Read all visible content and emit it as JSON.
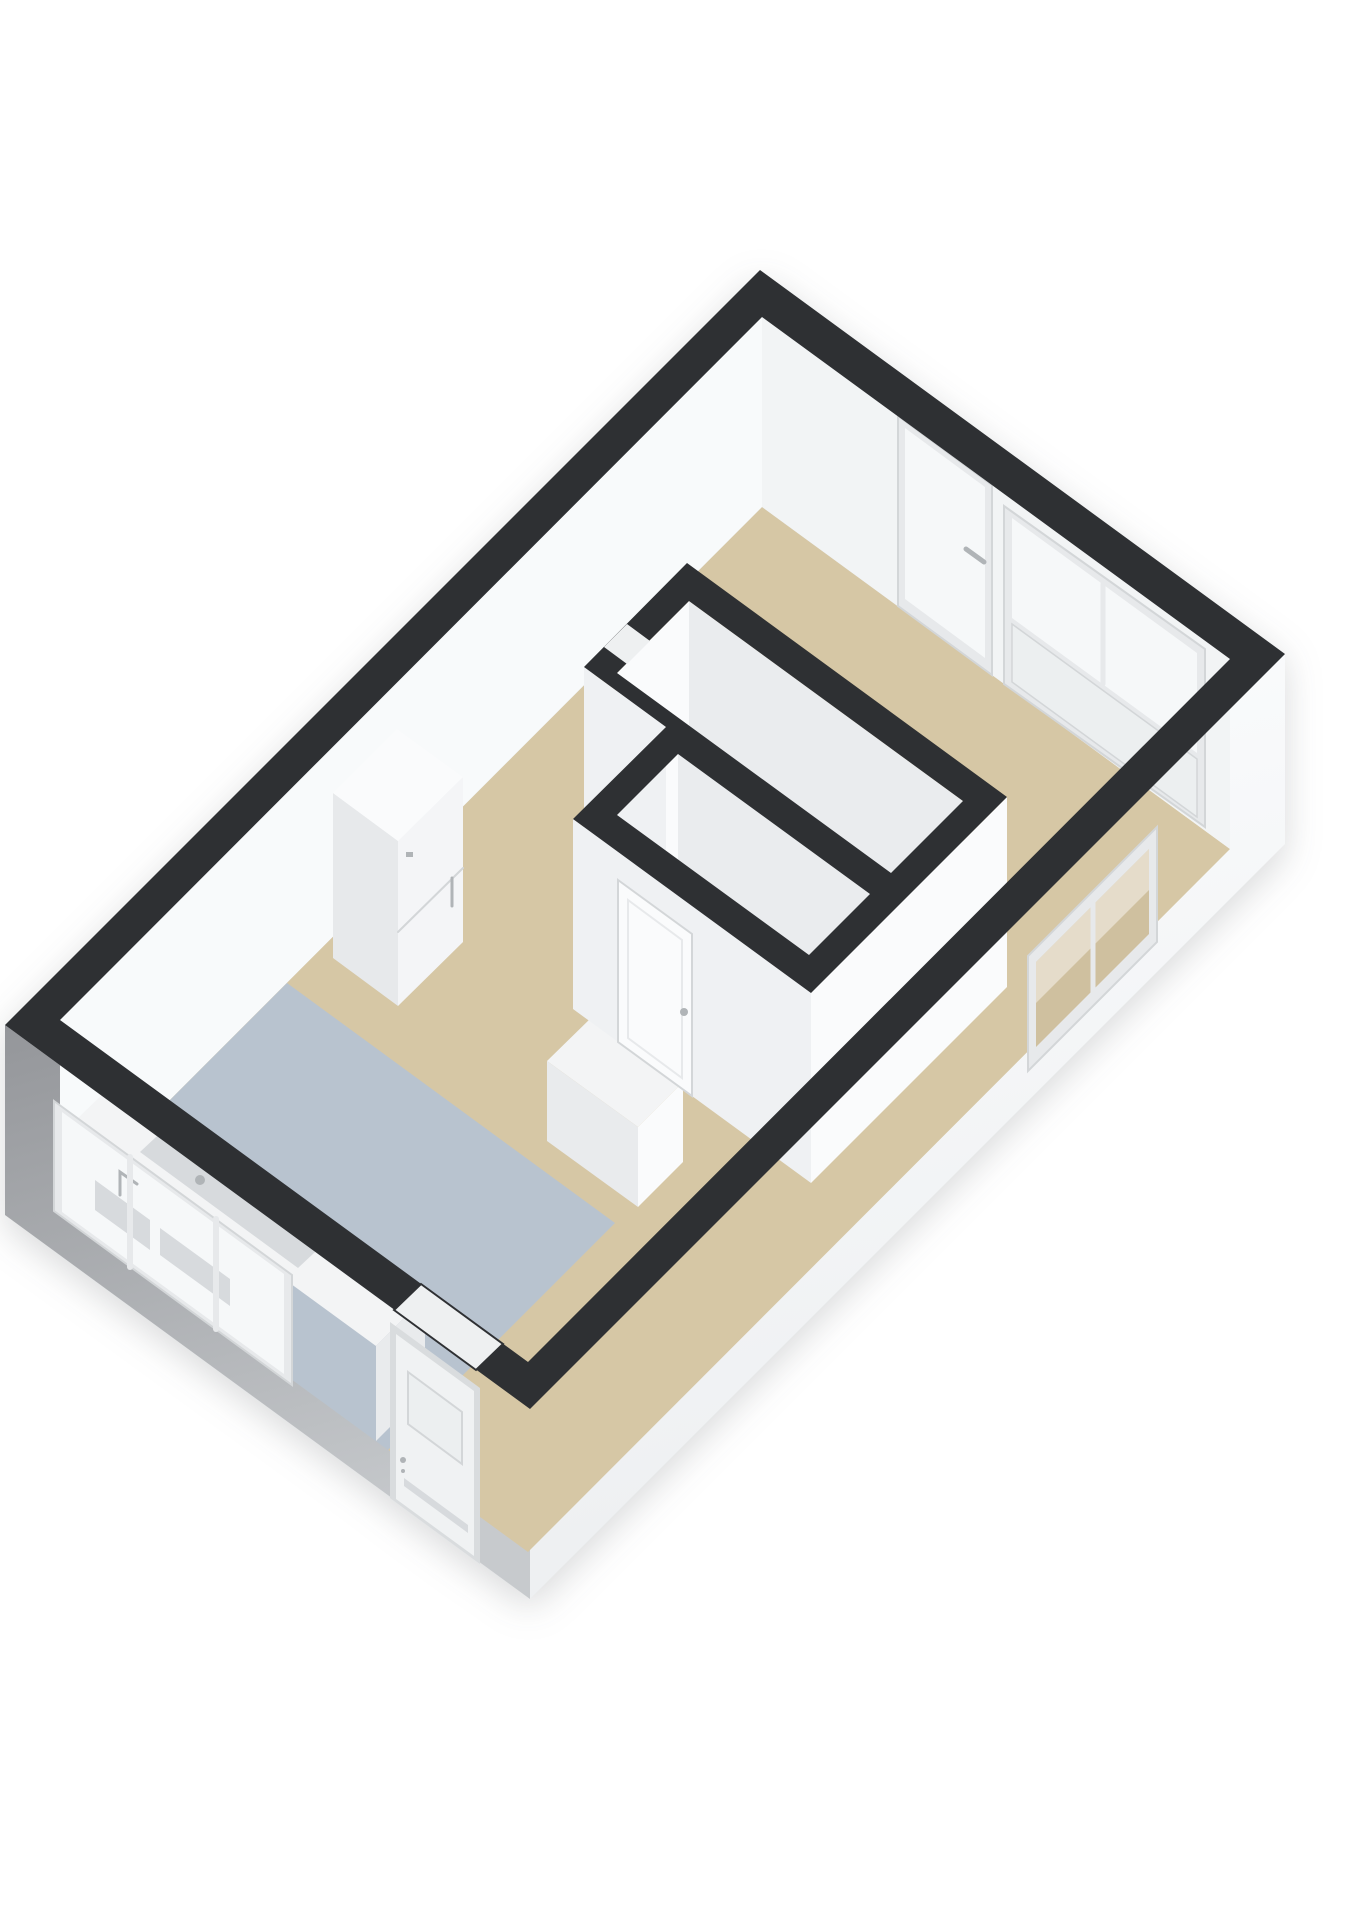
{
  "scene": {
    "type": "3d-floorplan-axonometric-view",
    "background": "#ffffff",
    "rooms": [
      {
        "id": "living-room",
        "floor_style": "beige",
        "floor_color_ref": "floor-beige"
      },
      {
        "id": "hallway",
        "floor_style": "beige",
        "floor_color_ref": "floor-beige"
      },
      {
        "id": "kitchen",
        "floor_style": "blue-gray",
        "floor_color_ref": "floor-kitchen"
      },
      {
        "id": "bathroom",
        "floor_style": "gray",
        "floor_color_ref": "floor-bathroom"
      },
      {
        "id": "toilet",
        "floor_style": "gray",
        "floor_color_ref": "floor-toilet"
      }
    ],
    "fixtures": [
      {
        "id": "tall-cabinet",
        "desc": "tall white boiler/cabinet unit against north-west wall"
      },
      {
        "id": "kitchen-counter",
        "desc": "white counter with sink along south-west wall"
      },
      {
        "id": "low-cabinet",
        "desc": "low white cabinet beside toilet block"
      }
    ],
    "openings": [
      {
        "id": "balcony-door",
        "wall": "north-east",
        "kind": "glazed door with handle"
      },
      {
        "id": "balcony-window",
        "wall": "north-east",
        "kind": "wide window with sill panel"
      },
      {
        "id": "side-window",
        "wall": "south-east",
        "kind": "window cut into outer wall"
      },
      {
        "id": "kitchen-window",
        "wall": "south-west",
        "kind": "wide window, sink visible through glass"
      },
      {
        "id": "entry-door",
        "wall": "south-west",
        "kind": "entrance door with glass pane and push bar"
      },
      {
        "id": "toilet-door",
        "wall": "interior",
        "kind": "closed door with handle"
      },
      {
        "id": "bathroom-door-opening",
        "wall": "interior",
        "kind": "open doorway notch in wall top"
      }
    ]
  },
  "colors": {
    "band": "#2e3033",
    "ext-gray-1": "#94969a",
    "ext-gray-2": "#c7cacd",
    "ext-white-1": "#fcfdfe",
    "ext-white-2": "#edeff1",
    "inner-nw": "#f8fafb",
    "inner-ne": "#f2f4f5",
    "floor-beige": "#d6c7a5",
    "floor-kitchen": "#b8c3cf",
    "floor-bathroom": "#a4a7aa",
    "floor-toilet": "#a8abae",
    "wall-bright": "#fafbfc",
    "wall-shade": "#eaecee",
    "wall-mid": "#eff1f3",
    "frame": "#e7e9eb",
    "frame-dark": "#d3d6d8",
    "glass": "#f6f8f9",
    "glass-tint": "#eceff0",
    "door": "#f0f2f3",
    "door-frame": "#d9dcde",
    "cabinet-front": "#f4f5f7",
    "cabinet-side": "#e7e9eb",
    "cabinet-top": "#fafbfc",
    "counter-top": "#f3f4f5",
    "counter-side": "#e9ebed",
    "beige-through": "#cfc09f",
    "fitting": "#d7dadd",
    "metal": "#b0b4b7",
    "reveal": "#eef0f1",
    "shadow": "rgba(45,50,55,0.18)"
  }
}
